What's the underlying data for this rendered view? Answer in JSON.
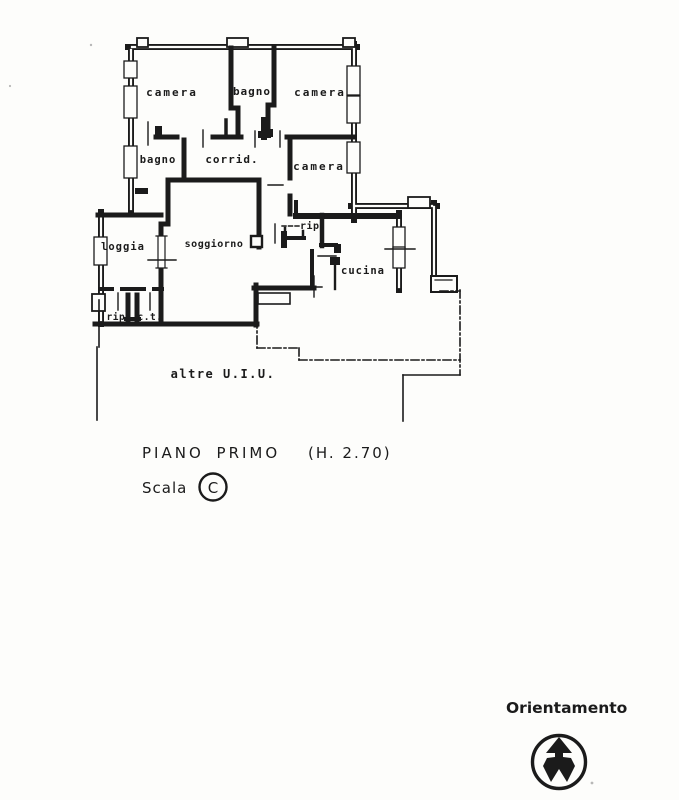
{
  "plan": {
    "rooms": [
      {
        "id": "camera-nw",
        "label": "camera"
      },
      {
        "id": "bagno-n",
        "label": "bagno"
      },
      {
        "id": "camera-ne",
        "label": "camera"
      },
      {
        "id": "bagno-w",
        "label": "bagno"
      },
      {
        "id": "corridoio",
        "label": "corrid."
      },
      {
        "id": "camera-e",
        "label": "camera"
      },
      {
        "id": "loggia",
        "label": "loggia"
      },
      {
        "id": "soggiorno",
        "label": "soggiorno"
      },
      {
        "id": "ripostiglio-e",
        "label": "rip."
      },
      {
        "id": "cucina",
        "label": "cucina"
      },
      {
        "id": "ripostiglio-sw",
        "label": "rip."
      },
      {
        "id": "centrale-termica",
        "label": "c.t."
      },
      {
        "id": "altre-uiu",
        "label": "altre  U.I.U."
      }
    ]
  },
  "captions": {
    "floor_title": "PIANO  PRIMO",
    "floor_height": "(H.  2.70)",
    "scale_label": "Scala",
    "scale_letter": "C"
  },
  "orientation": {
    "label": "Orientamento",
    "icon": "north-arrow-in-circle"
  },
  "colors": {
    "ink": "#1b1b1b",
    "paper": "#fdfdfb"
  }
}
